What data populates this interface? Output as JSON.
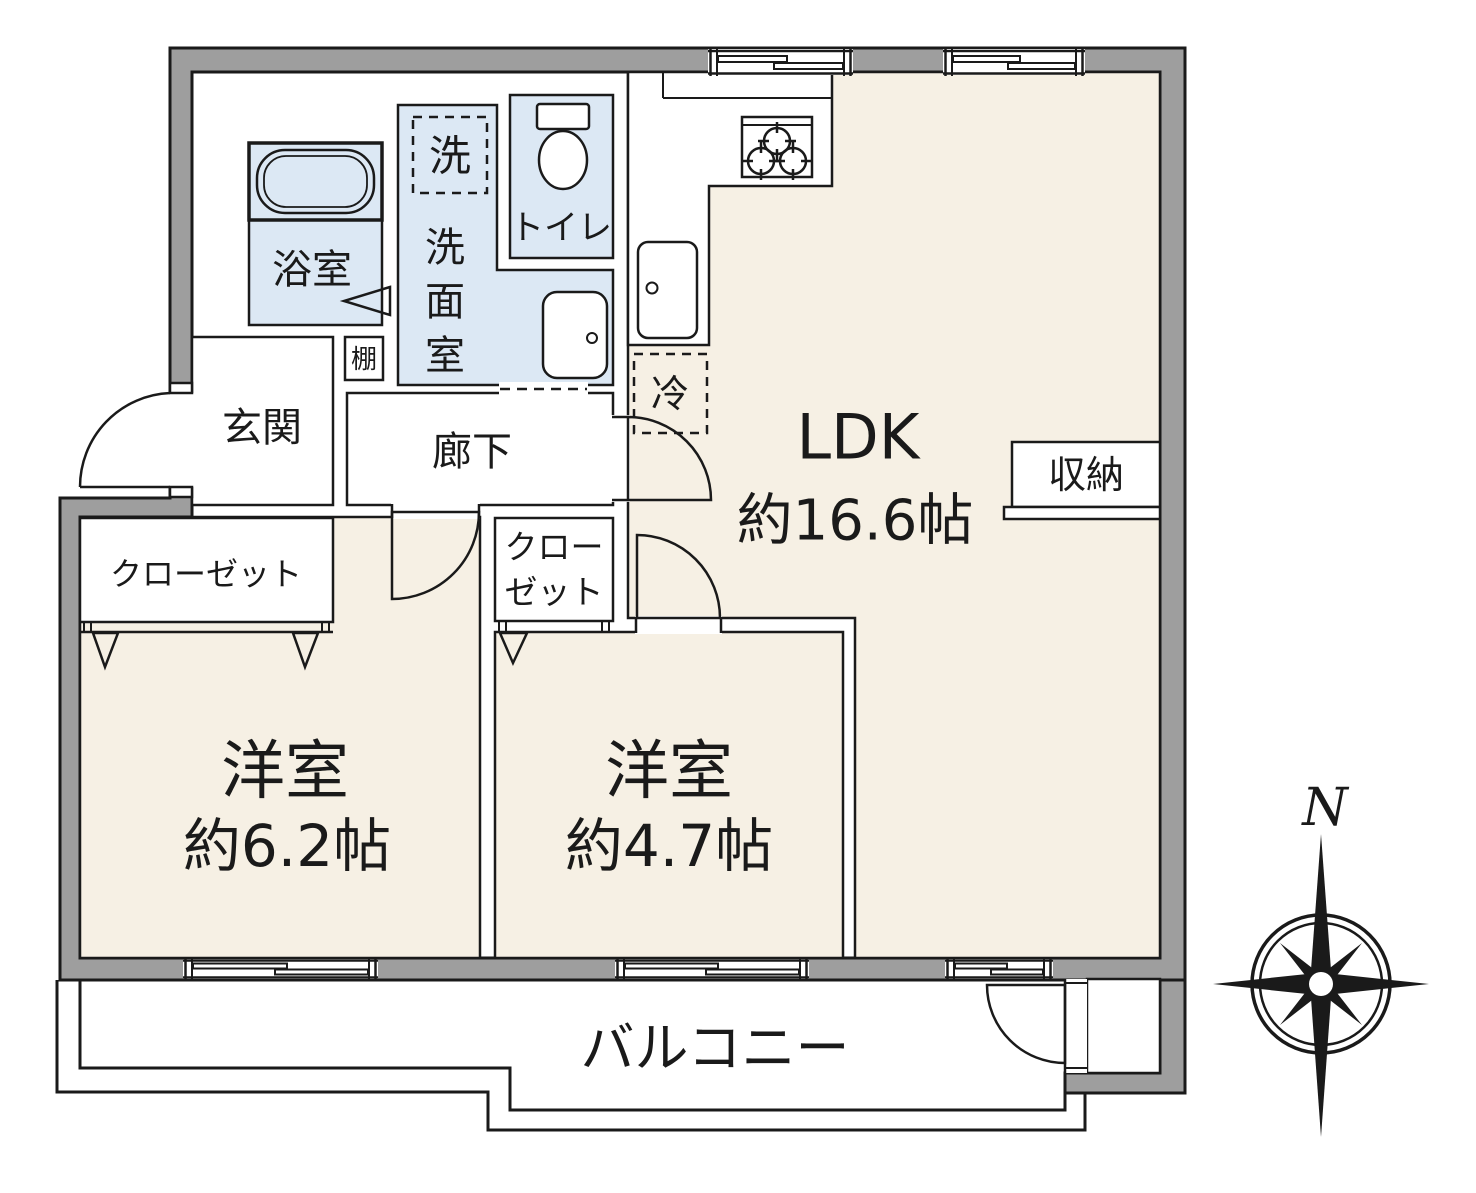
{
  "floorplan": {
    "rooms": {
      "ldk": {
        "label": "LDK",
        "size": "約16.6帖"
      },
      "bedroom1": {
        "label": "洋室",
        "size": "約6.2帖"
      },
      "bedroom2": {
        "label": "洋室",
        "size": "約4.7帖"
      },
      "bathroom": {
        "label": "浴室"
      },
      "washroom": {
        "chars": [
          "洗",
          "面",
          "室"
        ]
      },
      "toilet": {
        "label": "トイレ"
      },
      "entrance": {
        "label": "玄関"
      },
      "hallway": {
        "label": "廊下"
      },
      "balcony": {
        "label": "バルコニー"
      }
    },
    "fixtures": {
      "washer_box": "洗",
      "fridge_box": "冷",
      "shelf": "棚",
      "storage": "収納",
      "closet_main": "クローゼット",
      "closet_small_line1": "クロー",
      "closet_small_line2": "ゼット"
    },
    "compass": {
      "north": "N"
    },
    "colors": {
      "wall_gray": "#9e9e9e",
      "floor_cream": "#f6f0e4",
      "wet_area_blue": "#dce8f4",
      "line_black": "#1a1a1a"
    }
  }
}
